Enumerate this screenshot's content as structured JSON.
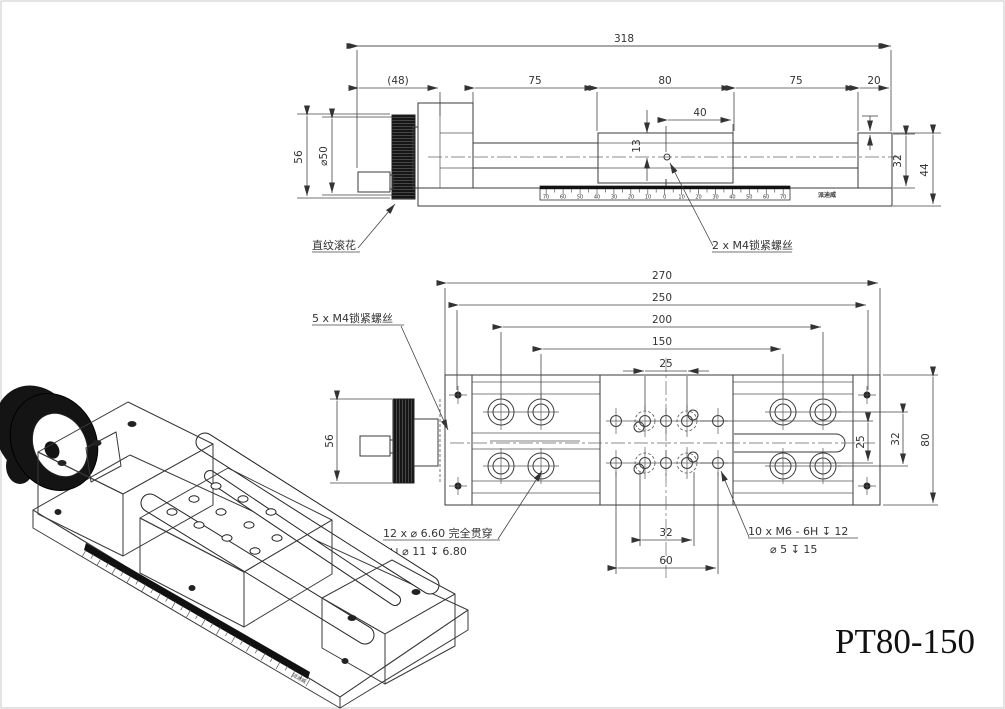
{
  "title": {
    "part_number": "PT80-150"
  },
  "top_view": {
    "dims": {
      "overall": "318",
      "knob_section": "(48)",
      "seg_a": "75",
      "seg_b": "80",
      "seg_c": "75",
      "seg_d": "20",
      "carriage_top": "40",
      "center_height": "13",
      "wheel_height": "56",
      "wheel_dia": "⌀50",
      "right_inner": "32",
      "right_outer": "44"
    },
    "labels": {
      "knurl": "直纹滚花",
      "lock_screws": "2 x M4锁紧螺丝"
    },
    "ruler": {
      "numbers": [
        "70",
        "60",
        "50",
        "40",
        "30",
        "20",
        "10",
        "0",
        "10",
        "20",
        "30",
        "40",
        "50",
        "60",
        "70"
      ],
      "brand": "派迪威"
    }
  },
  "plan_view": {
    "dims": {
      "overall": "270",
      "mount_span": "250",
      "hole_span_a": "200",
      "hole_span_b": "150",
      "thread_span": "25",
      "wheel_height": "56",
      "right_rows_a": "25",
      "right_rows_b": "32",
      "width": "80",
      "bottom_a": "32",
      "bottom_b": "60"
    },
    "labels": {
      "lock_screws": "5 x M4锁紧螺丝"
    },
    "callouts": {
      "through_holes_1": "12 x ⌀ 6.60 完全贯穿",
      "through_holes_2": "⊔ ⌀ 11 ↧ 6.80",
      "threaded_holes_1": "10 x M6 - 6H ↧ 12",
      "threaded_holes_2": "⌀ 5 ↧ 15"
    }
  },
  "iso_view": {
    "brand": "派迪威"
  }
}
